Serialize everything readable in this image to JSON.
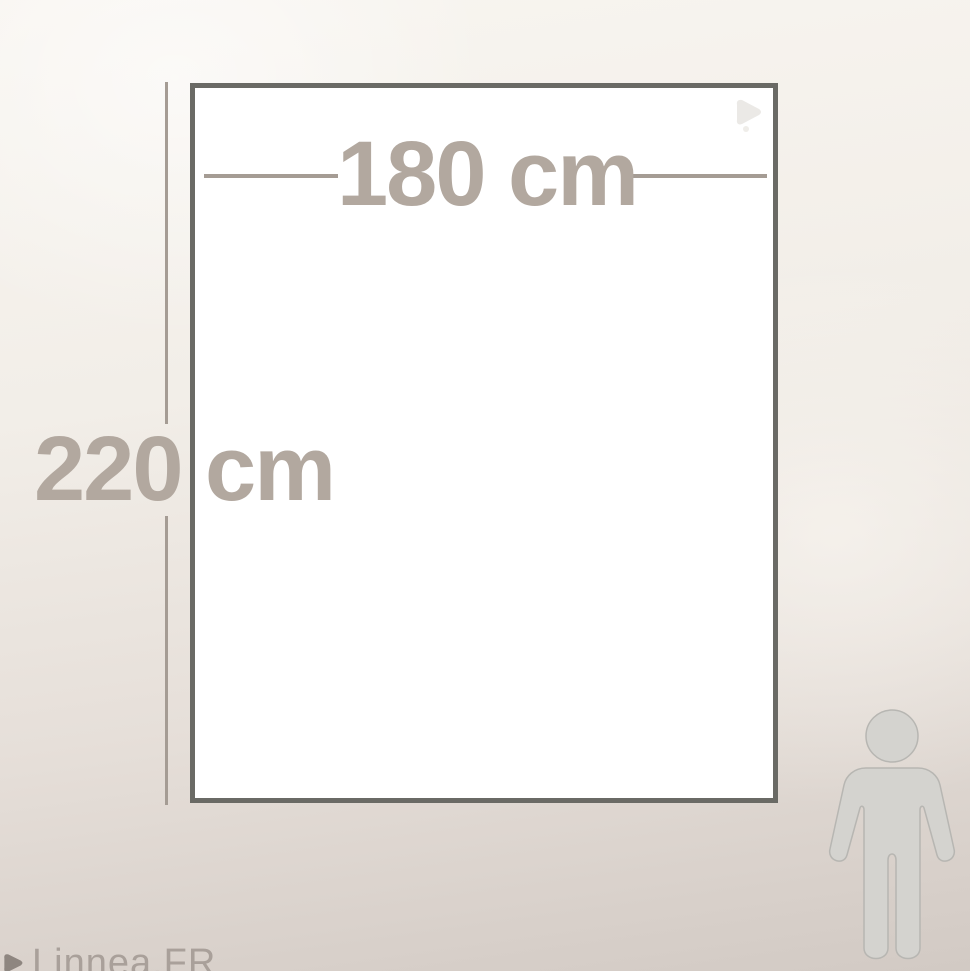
{
  "dimensions": {
    "width_label": "180 cm",
    "height_label": "220 cm"
  },
  "watermark": {
    "text": "Linnea.FR"
  },
  "icons": {
    "sheet_logo": "linnea-leaf-logo",
    "watermark_leaf": "leaf",
    "person": "human-figure-for-scale"
  },
  "colors": {
    "label_text": "#b2a89f",
    "dimension_line": "#a59c94",
    "sheet_fill": "#ffffff",
    "sheet_border": "#6a6a65",
    "figure_fill": "#d4d3cf",
    "figure_outline": "#b7b6b2",
    "background_top": "#f8f5f0",
    "background_bottom": "#d2cac4",
    "watermark_text": "#a9a09a",
    "watermark_leaf": "#8e8680",
    "sheet_logo": "#ebe9e6"
  }
}
